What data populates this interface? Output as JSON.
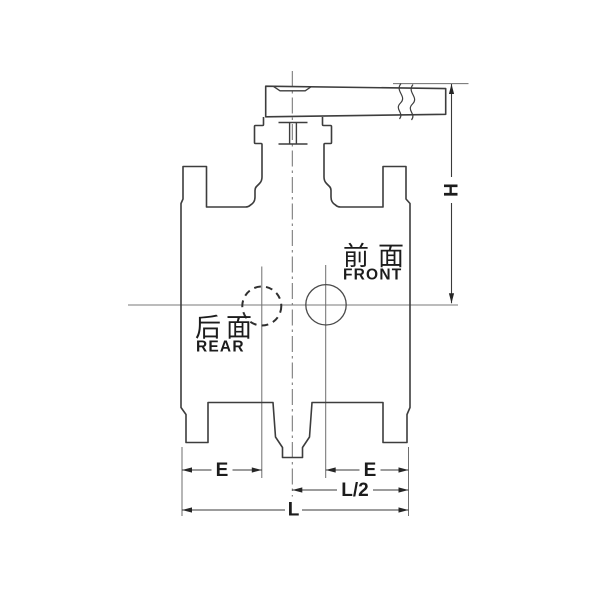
{
  "drawing": {
    "title": "flanged ball valve front view engineering drawing",
    "annotations": {
      "front": {
        "cn": "前面",
        "en": "FRONT"
      },
      "rear": {
        "cn": "后面",
        "en": "REAR"
      }
    },
    "dimension_labels": {
      "height": "H",
      "e_left": "E",
      "e_right": "E",
      "half_length": "L/2",
      "overall_length": "L"
    },
    "colors": {
      "background": "#ffffff",
      "outline": "#3d3d3d",
      "thin_line": "#6e6e6e",
      "dimension_line": "#3a3a3a",
      "text": "#1c1c1c"
    }
  }
}
